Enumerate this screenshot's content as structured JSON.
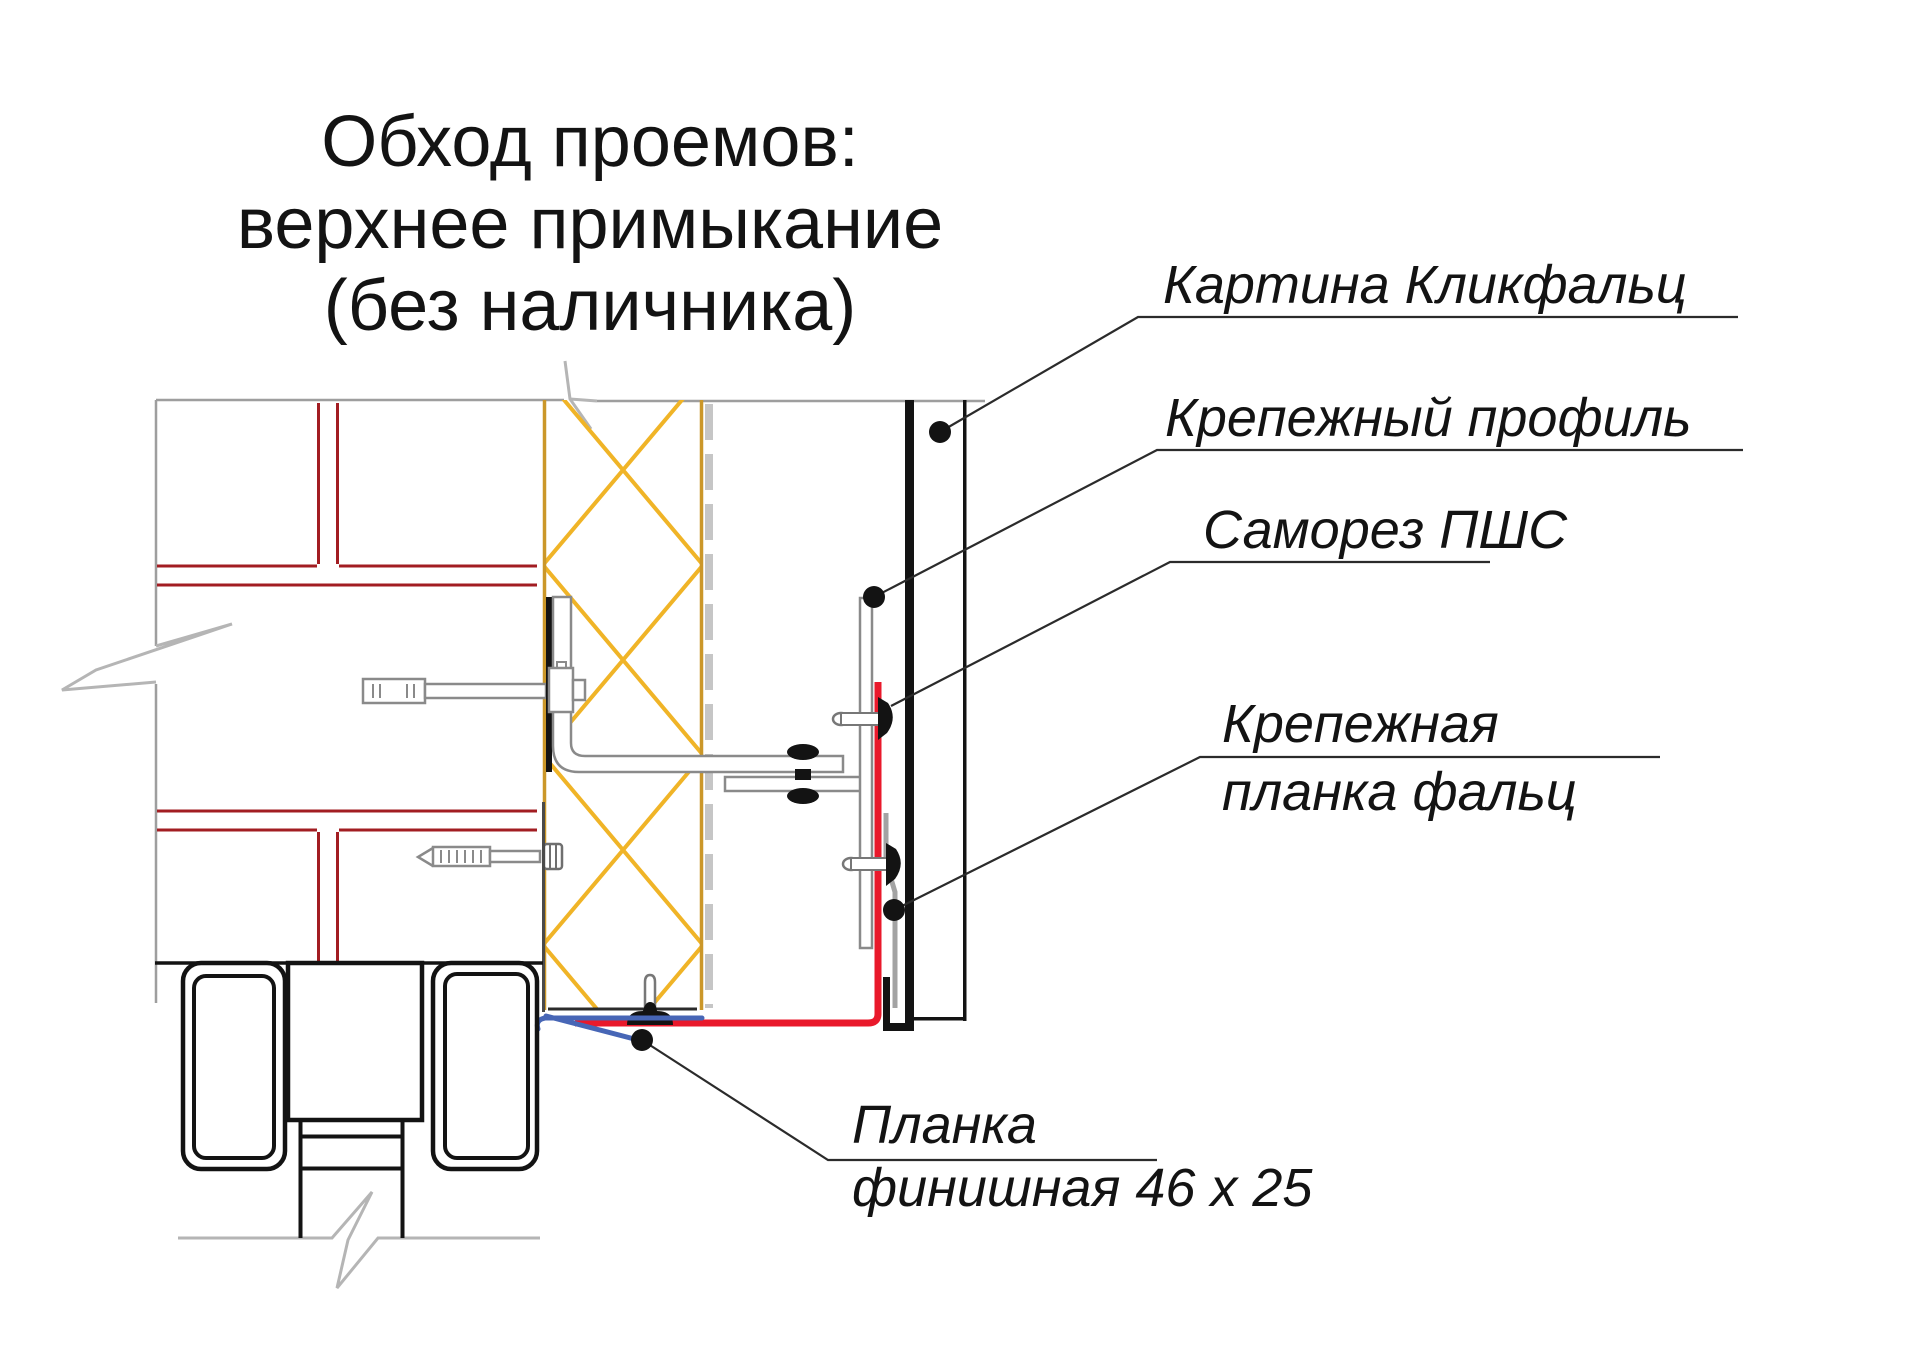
{
  "title": {
    "line1": "Обход проемов:",
    "line2": "верхнее примыкание",
    "line3": "(без наличника)"
  },
  "callouts": {
    "panel": "Картина Кликфальц",
    "profile": "Крепежный профиль",
    "screw": "Саморез ПШС",
    "falz_line1": "Крепежная",
    "falz_line2": "планка фальц",
    "finish_line1": "Планка",
    "finish_line2": "финишная 46 x 25"
  },
  "colors": {
    "background": "#ffffff",
    "wall_outline_grey": "#9E9E9E",
    "break_mark_grey": "#B5B5B5",
    "mortar_red": "#A21D22",
    "insulation_hatch_amber": "#F0B427",
    "insulation_edge_ochre": "#CB9729",
    "membrane_dash_grey": "#C6C6C6",
    "metal_outline_grey": "#8A8A8A",
    "falz_strip_grey": "#A3A3A3",
    "membrane_red": "#E9192B",
    "finish_strip_blue": "#4766B6",
    "panel_black": "#131313",
    "leader_line": "#2B2B2B",
    "text": "#131313"
  }
}
